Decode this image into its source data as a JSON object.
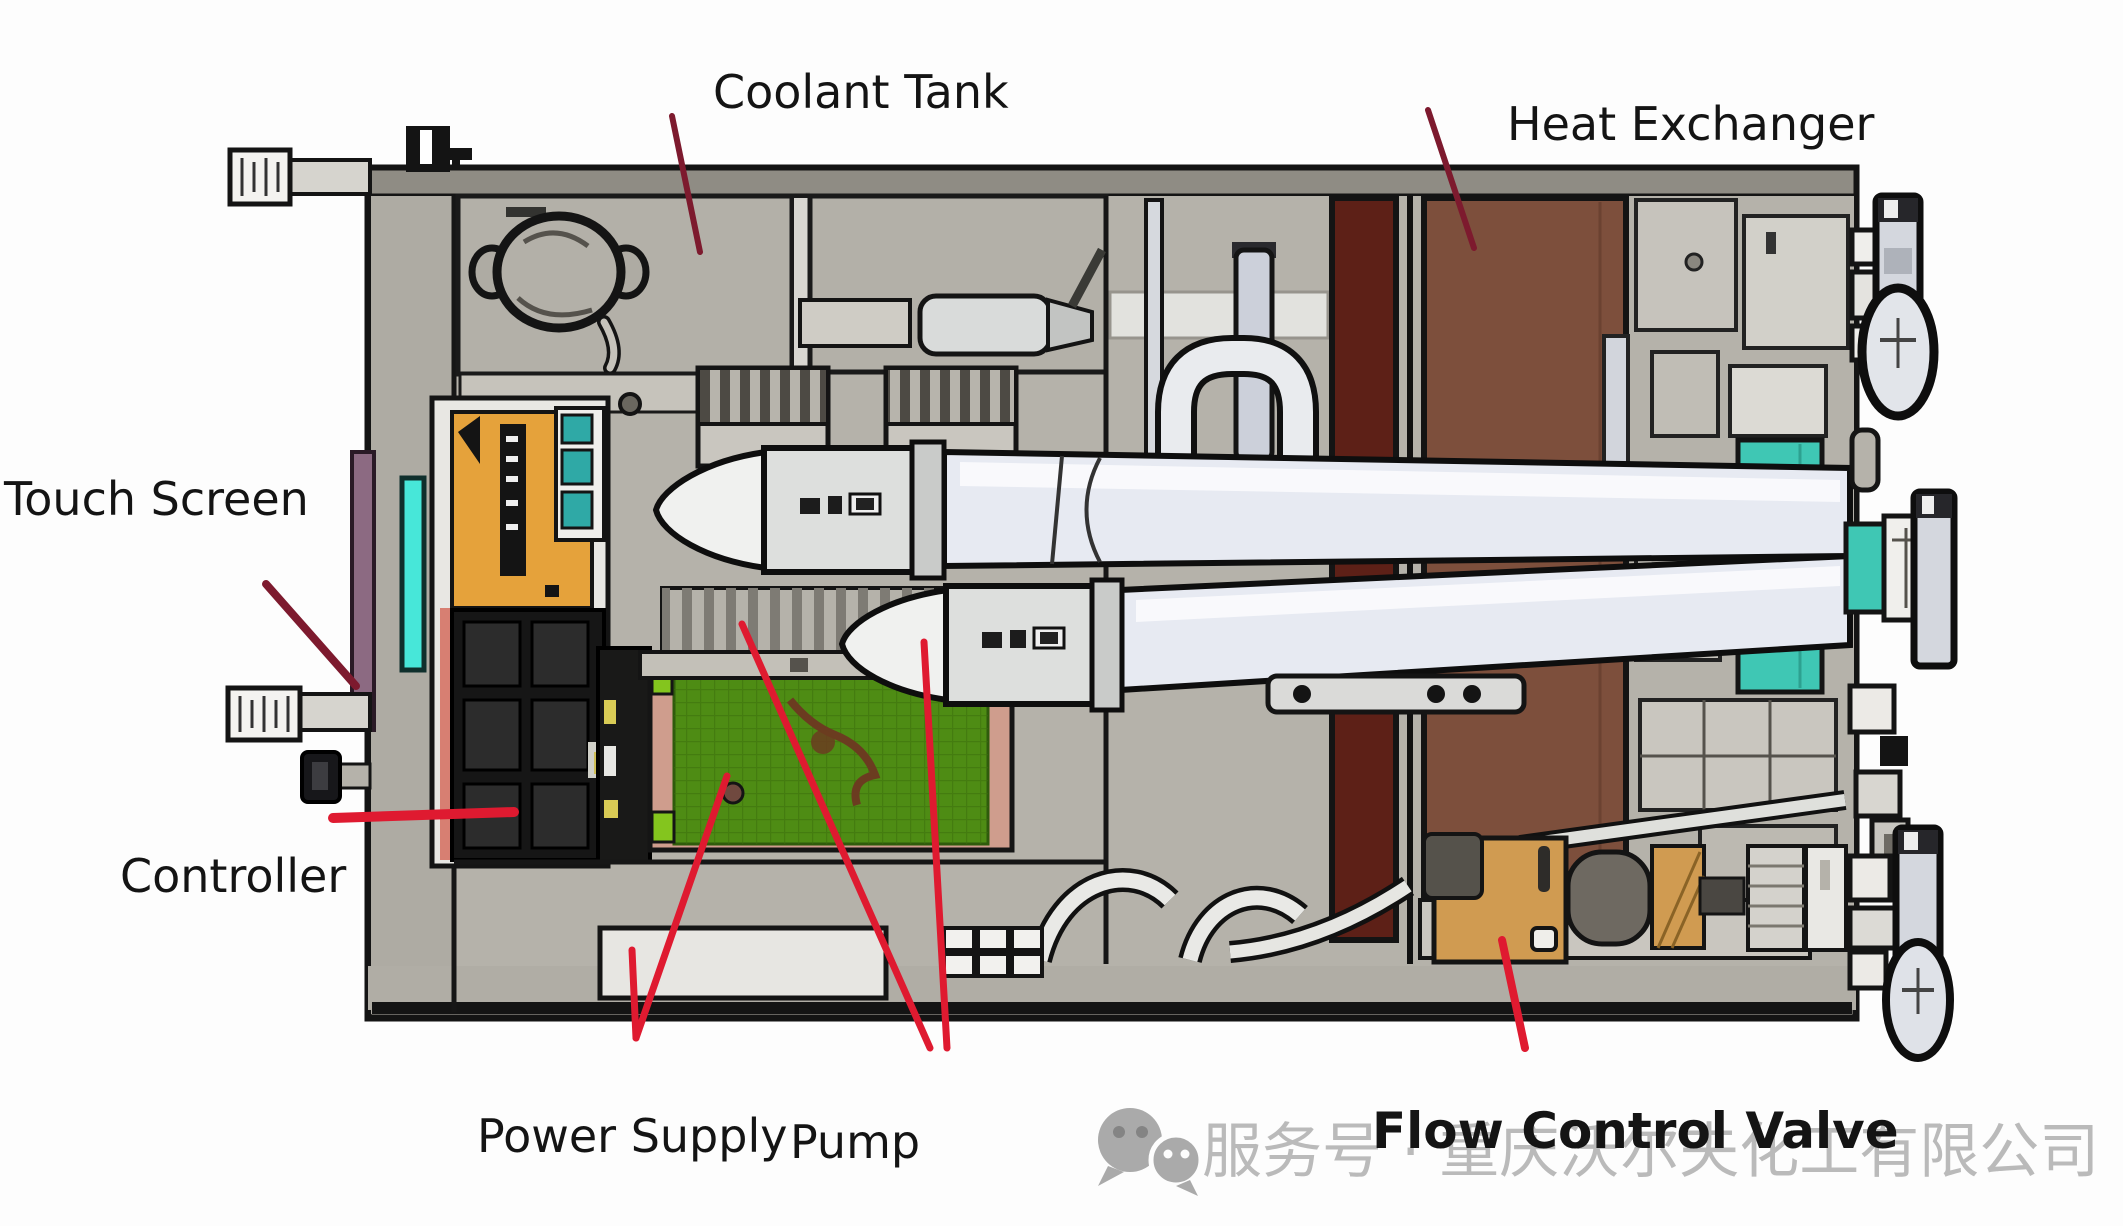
{
  "labels": {
    "coolant_tank": "Coolant Tank",
    "heat_exchanger": "Heat Exchanger",
    "touch_screen": "Touch Screen",
    "controller": "Controller",
    "power_supply": "Power Supply",
    "pump": "Pump",
    "flow_control_valve": "Flow Control Valve"
  },
  "watermark": {
    "icon": "wechat-icon",
    "text": "服务号 · 重庆沃尔夫化工有限公司"
  },
  "colors": {
    "ink": "#141414",
    "leader_red": "#df1a30",
    "leader_dark_red": "#7d1a2e",
    "pcb_green": "#4e8c14",
    "pcb_frame_salmon": "#cf9d8d",
    "lime_chip": "#84c51e",
    "psu_orange": "#e5a23b",
    "screen_cyan": "#47e7d9",
    "bezel_purple": "#8c6a82",
    "hx_brown": "#7d4f3c",
    "hx_maroon": "#5d2017",
    "teal_panel": "#3fc7b4",
    "teal_tabs": "#2fa9a6",
    "valve_tan": "#d09b51",
    "watermark_gray": "#a6a6a6"
  }
}
